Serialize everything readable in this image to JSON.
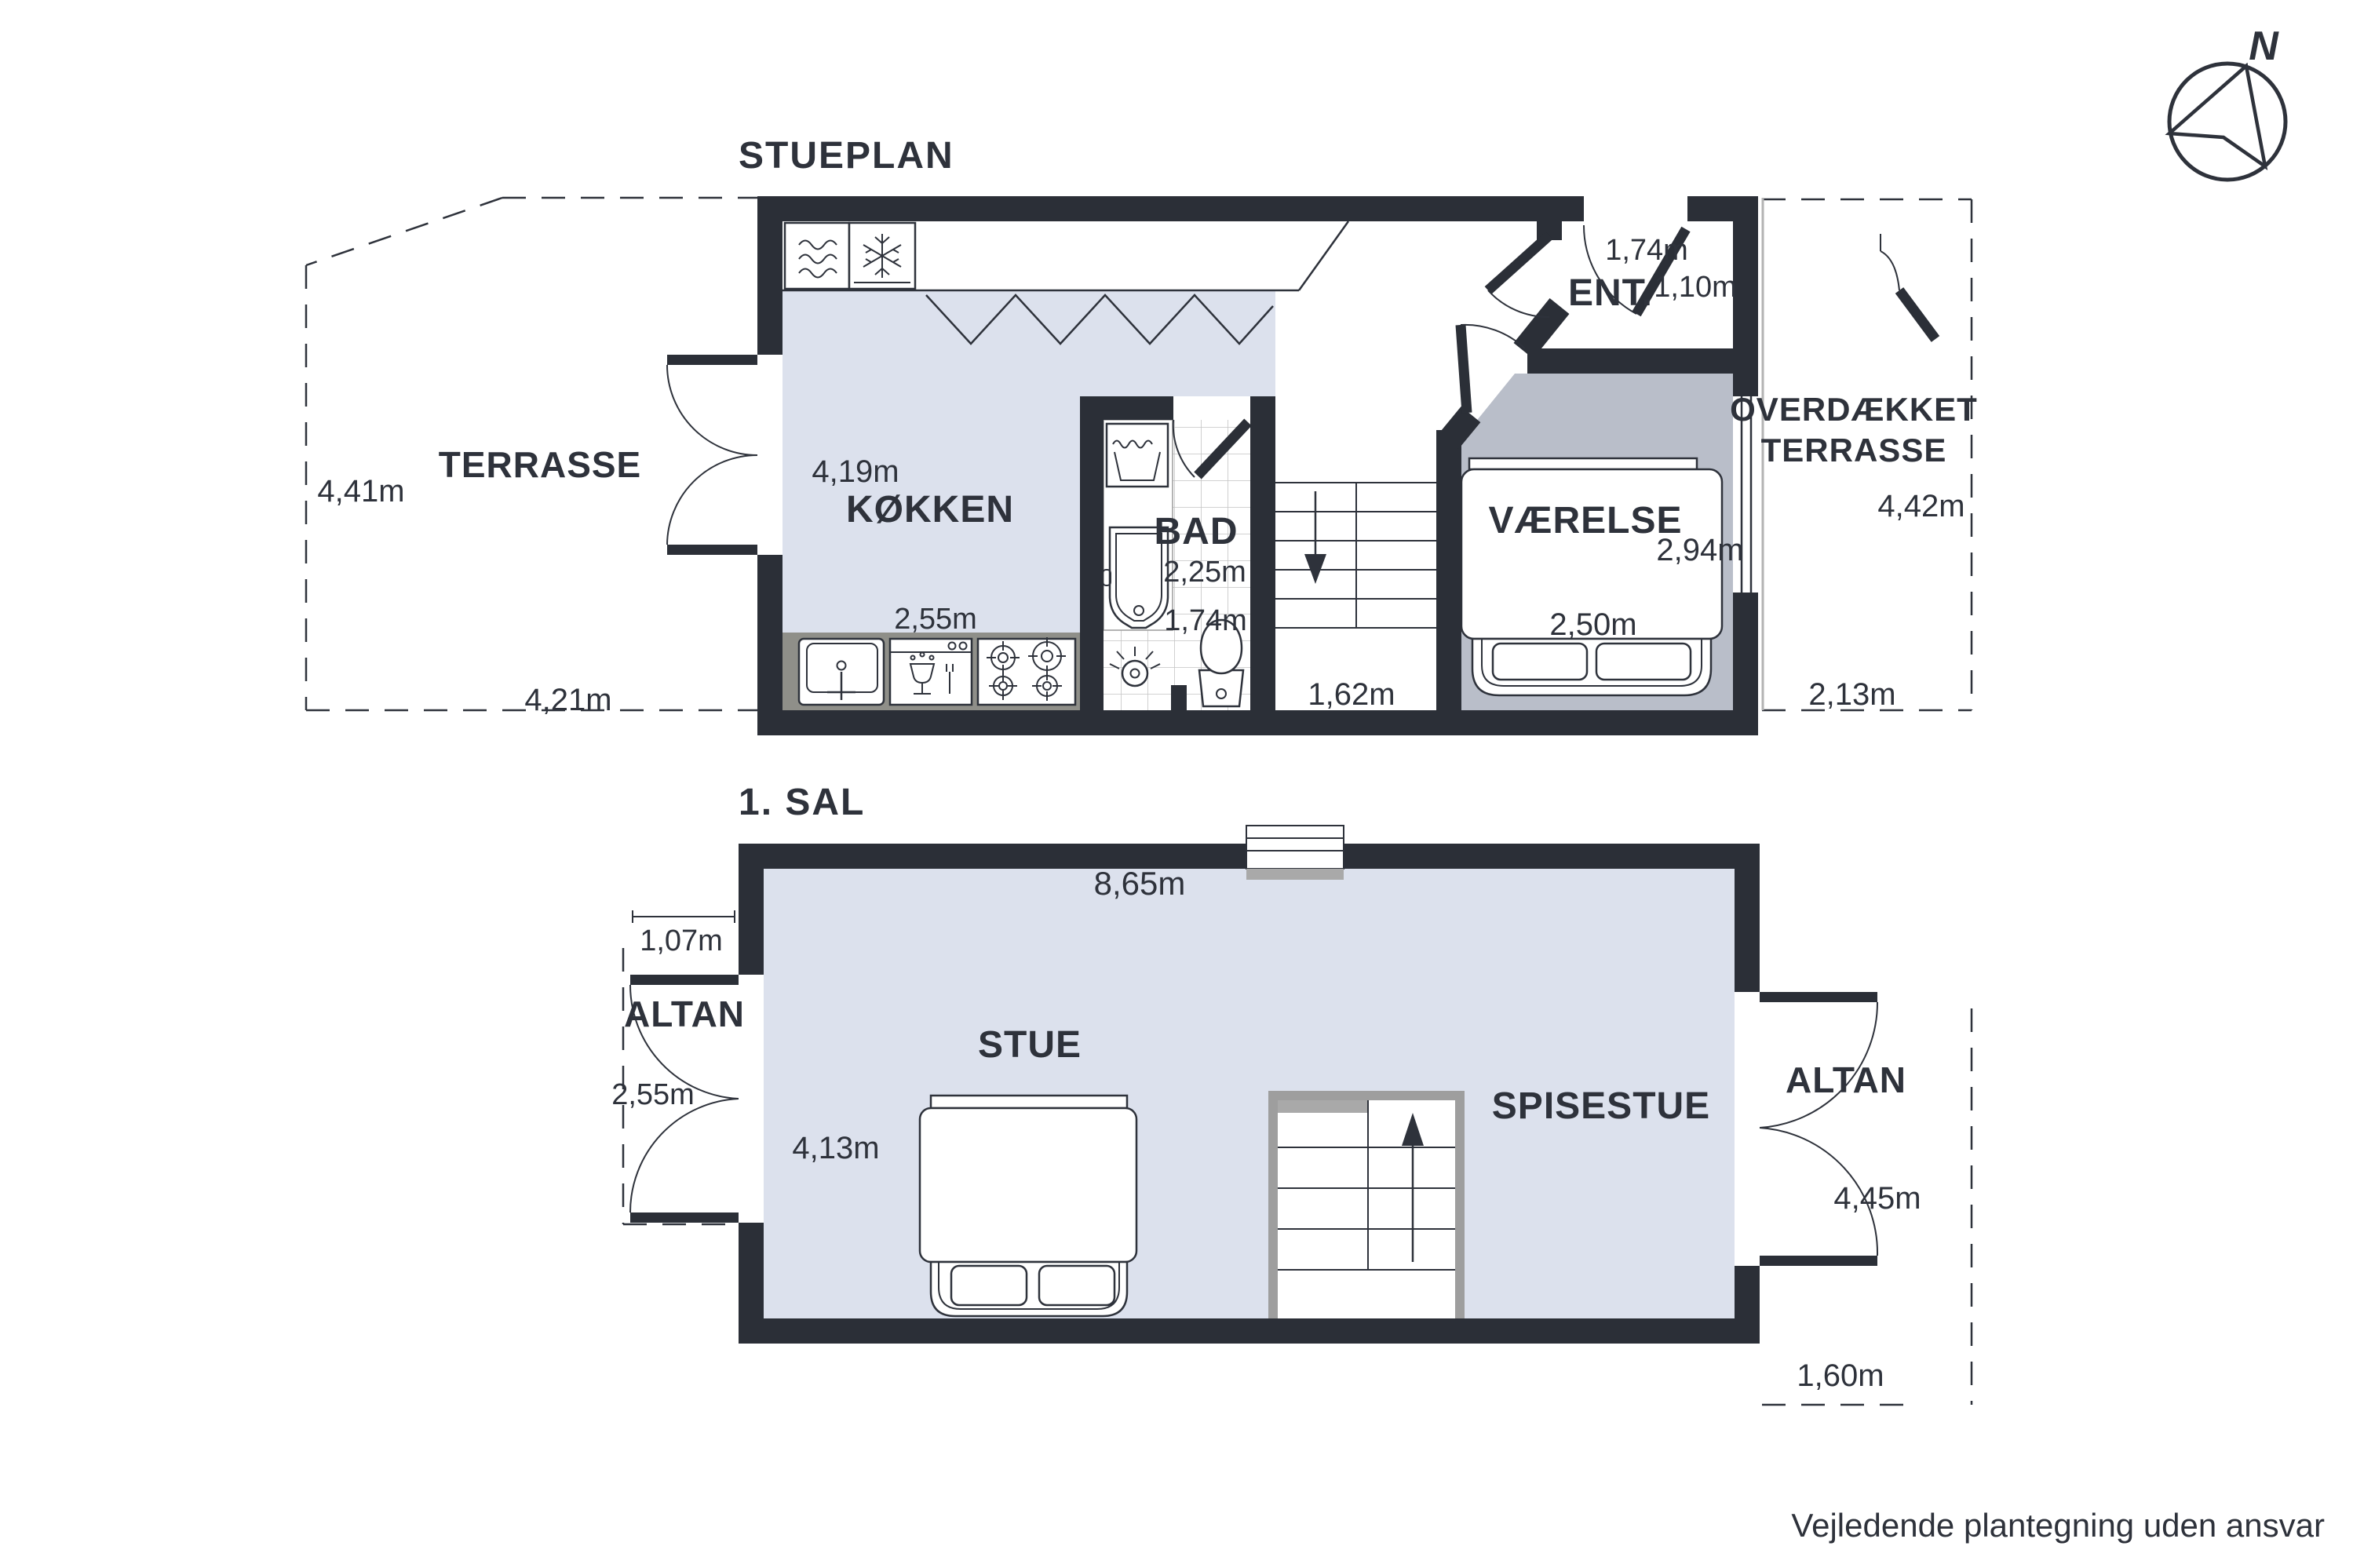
{
  "colors": {
    "ink": "#2e323b",
    "wall": "#2b2f37",
    "floor-light": "#dce1ed",
    "floor-dark": "#b9bec9",
    "counter": "#8f8f89",
    "sill": "#a9a9a9",
    "stairframe": "#9e9e9e",
    "tile": "#c4c4c4",
    "roof": "#b3b3b3"
  },
  "header": {
    "ground_title": "STUEPLAN",
    "first_title": "1. SAL"
  },
  "compass": {
    "north_label": "N"
  },
  "footer": {
    "disclaimer": "Vejledende plantegning uden ansvar"
  },
  "ground_floor": {
    "terrace": {
      "label": "TERRASSE",
      "height_m": "4,41m",
      "width_m": "4,21m"
    },
    "kitchen": {
      "label": "KØKKEN",
      "width_m": "4,19m",
      "counter_m": "2,55m"
    },
    "bath": {
      "label": "BAD",
      "width_m": "2,25m",
      "depth_m": "1,74m"
    },
    "hall": {
      "stair_m": "1,62m"
    },
    "entry": {
      "label": "ENT.",
      "width_m": "1,74m",
      "door_m": "1,10m"
    },
    "bedroom": {
      "label": "VÆRELSE",
      "height_m": "2,94m",
      "width_m": "2,50m"
    },
    "covered_terrace": {
      "label_line1": "OVERDÆKKET",
      "label_line2": "TERRASSE",
      "height_m": "4,42m",
      "width_m": "2,13m"
    }
  },
  "first_floor": {
    "overall_width_m": "8,65m",
    "living": {
      "label": "STUE",
      "width_m": "4,13m"
    },
    "dining": {
      "label": "SPISESTUE"
    },
    "balcony_left": {
      "label": "ALTAN",
      "door_m": "1,07m",
      "depth_m": "2,55m"
    },
    "balcony_right": {
      "label": "ALTAN",
      "height_m": "4,45m",
      "width_m": "1,60m"
    }
  }
}
